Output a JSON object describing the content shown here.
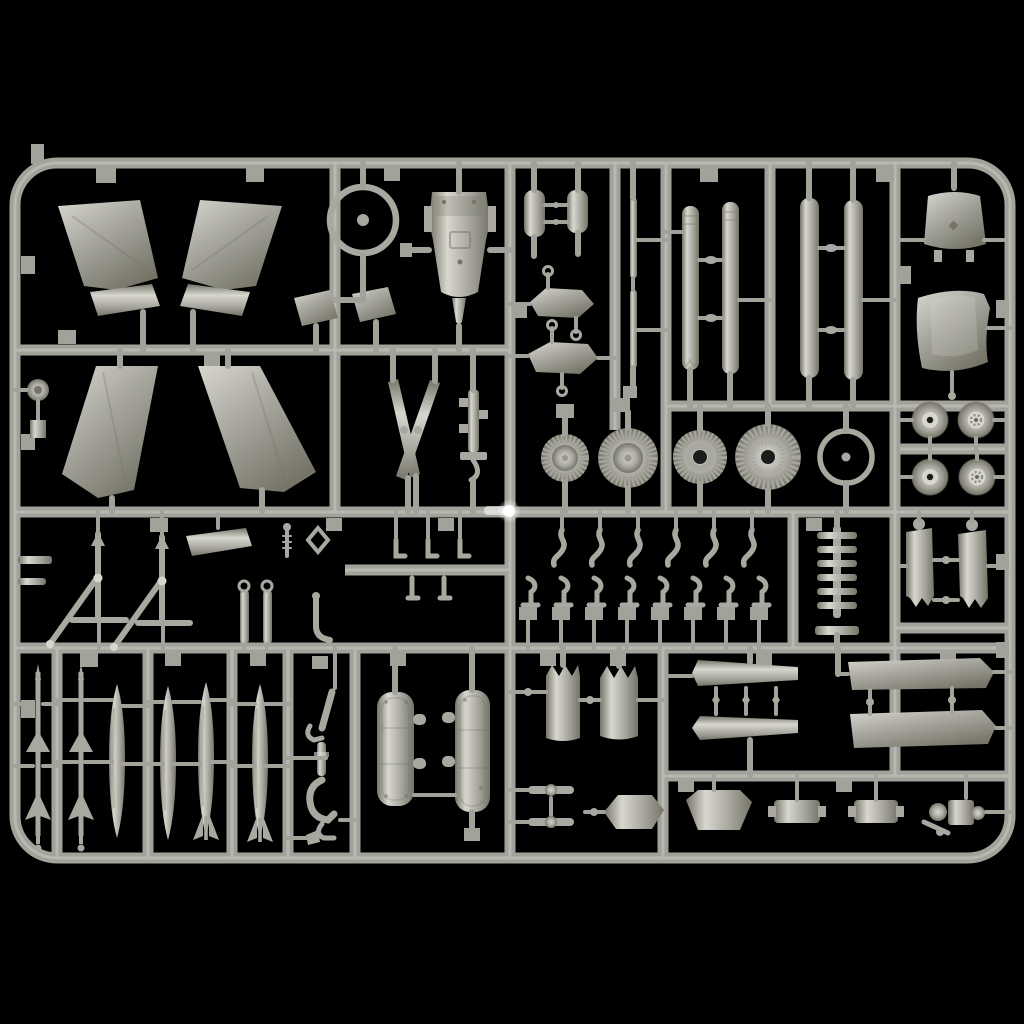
{
  "scene": {
    "alt": "Light gray injection-molded plastic sprue (parts tree) of an aircraft model kit photographed on a black background",
    "background": "black",
    "material": "gray styrene plastic"
  },
  "colors": {
    "bg": "#000000",
    "run": "#a3a29a",
    "run_hi": "#cfcec6",
    "run_lo": "#6c6b63",
    "p_hi": "#d8d7cf",
    "p_mid": "#a9a8a0",
    "p_dk": "#757467",
    "hole": "#1c1c1a",
    "glare": "#ffffff"
  },
  "parts": [
    {
      "name": "horizontal-stabilizer",
      "count": 2
    },
    {
      "name": "stabilizer-flap",
      "count": 2
    },
    {
      "name": "access-panel",
      "count": 2
    },
    {
      "name": "main-wing",
      "count": 2
    },
    {
      "name": "spoked-rim-wheel",
      "count": 2
    },
    {
      "name": "cockpit-tub",
      "count": 1
    },
    {
      "name": "antenna-blade",
      "count": 2
    },
    {
      "name": "equipment-bracket",
      "count": 1
    },
    {
      "name": "hub-cap",
      "count": 1
    },
    {
      "name": "instrument-panel",
      "count": 2
    },
    {
      "name": "hinge-plate",
      "count": 2
    },
    {
      "name": "pitot-strip",
      "count": 2
    },
    {
      "name": "engine-fan-disc",
      "count": 4
    },
    {
      "name": "intake-duct-half",
      "count": 4
    },
    {
      "name": "windscreen-frame",
      "count": 1
    },
    {
      "name": "fuselage-saddle",
      "count": 1
    },
    {
      "name": "road-wheel",
      "count": 4
    },
    {
      "name": "intake-ramp",
      "count": 2
    },
    {
      "name": "gear-retraction-strut",
      "count": 2
    },
    {
      "name": "gear-link",
      "count": 2
    },
    {
      "name": "actuator-screw",
      "count": 1
    },
    {
      "name": "trim-vane",
      "count": 1
    },
    {
      "name": "clevis-ring",
      "count": 1
    },
    {
      "name": "door-hinge-hook",
      "count": 1
    },
    {
      "name": "s-hook-lever",
      "count": 6
    },
    {
      "name": "l-post-lever",
      "count": 8
    },
    {
      "name": "vent-grille",
      "count": 1
    },
    {
      "name": "missile",
      "count": 2
    },
    {
      "name": "drop-tank",
      "count": 2
    },
    {
      "name": "finned-bomb",
      "count": 2
    },
    {
      "name": "main-gear-leg",
      "count": 1
    },
    {
      "name": "gear-bay-door",
      "count": 2
    },
    {
      "name": "afterburner-ring",
      "count": 2
    },
    {
      "name": "link-dumbbell",
      "count": 2
    },
    {
      "name": "hex-access-plate",
      "count": 2
    },
    {
      "name": "stabilator-half",
      "count": 2
    },
    {
      "name": "flap-panel",
      "count": 2
    },
    {
      "name": "strake-plate",
      "count": 2
    },
    {
      "name": "pump-assembly",
      "count": 1
    }
  ]
}
